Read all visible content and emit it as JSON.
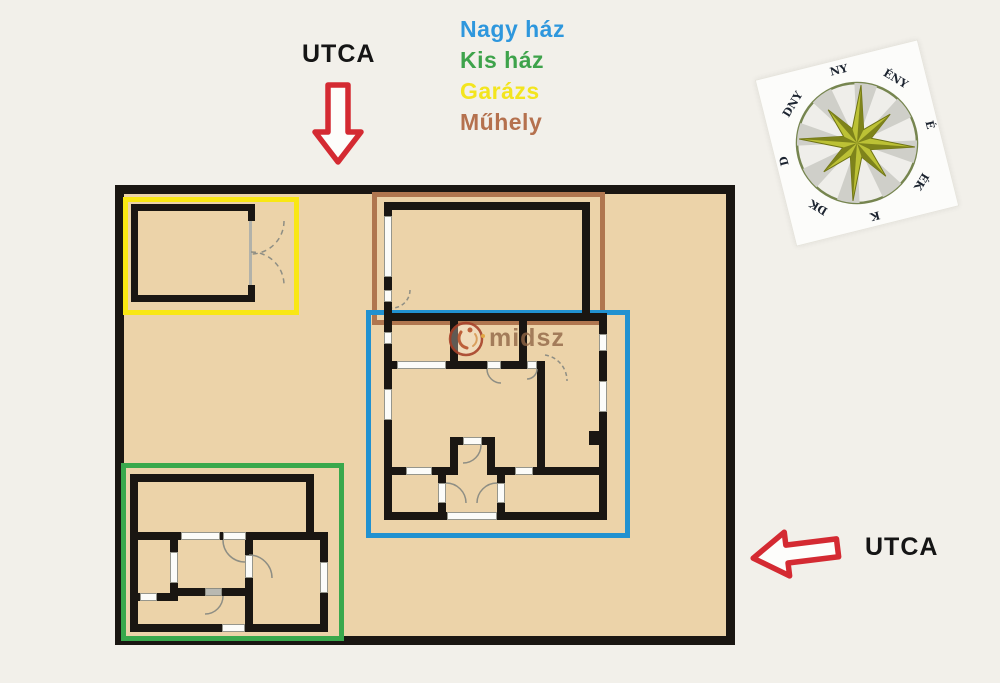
{
  "streets": {
    "top": "UTCA",
    "right": "UTCA"
  },
  "legend": {
    "items": [
      {
        "label": "Nagy ház",
        "color": "#2e97dd"
      },
      {
        "label": "Kis ház",
        "color": "#3ea34b"
      },
      {
        "label": "Garázs",
        "color": "#f3e51e"
      },
      {
        "label": "Műhely",
        "color": "#b5714e"
      }
    ]
  },
  "zones": {
    "big_house": {
      "color": "#2191d0"
    },
    "small_house": {
      "color": "#39a84c"
    },
    "garage": {
      "color": "#f9e713"
    },
    "workshop": {
      "color": "#b0764f"
    }
  },
  "compass": {
    "labels": [
      "É",
      "ÉK",
      "K",
      "DK",
      "D",
      "DNY",
      "NY",
      "ÉNY"
    ]
  },
  "watermark": {
    "text": "midsz"
  },
  "colors": {
    "page_bg": "#f2f0ea",
    "site_fill": "#ecd3a9",
    "wall": "#1a1612",
    "arrow_red": "#d42a32"
  }
}
